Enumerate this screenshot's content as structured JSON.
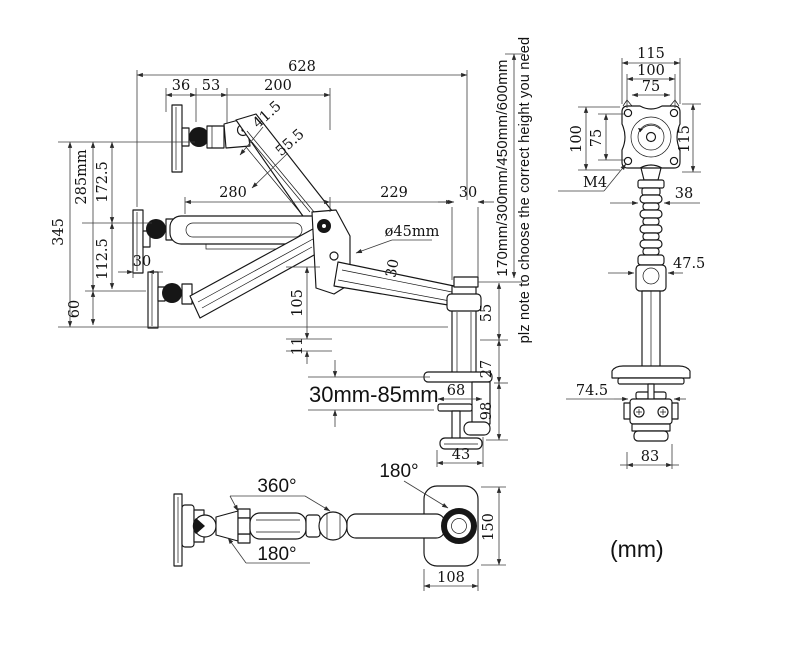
{
  "units_label": "(mm)",
  "note": {
    "pink_color": "#e8175f",
    "height_options": "170mm/300mm/450mm/600mm",
    "pink_note": "plz note to choose the correct height you need"
  },
  "side": {
    "d628": "628",
    "d36": "36",
    "d53": "53",
    "d200": "200",
    "d41_5": "41.5",
    "d55_5": "55.5",
    "d345": "345",
    "d285": "285mm",
    "d172_5": "172.5",
    "d112_5": "112.5",
    "d60": "60",
    "d30_plate": "30",
    "d280": "280",
    "d229": "229",
    "d30_pole": "30",
    "d45": "ø45mm",
    "d30_arm": "30",
    "d105": "105",
    "d11": "11",
    "d55": "55",
    "d27": "27",
    "d98": "98",
    "d68": "68",
    "d43": "43",
    "clamp_range": "30mm-85mm"
  },
  "front": {
    "d115_top": "115",
    "d100_top": "100",
    "d75_top": "75",
    "d100_left": "100",
    "d75_left": "75",
    "d115_right": "115",
    "m4": "M4",
    "d38": "38",
    "d47_5": "47.5",
    "d74_5": "74.5",
    "d83": "83"
  },
  "top": {
    "r360": "360°",
    "r180_top": "180°",
    "r180_bottom": "180°",
    "d150": "150",
    "d108": "108"
  }
}
